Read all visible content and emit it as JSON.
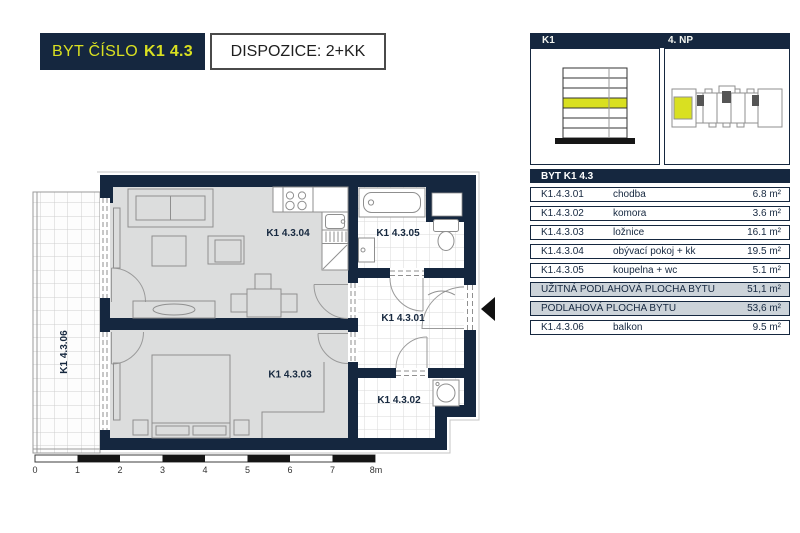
{
  "header": {
    "badge": {
      "prefix": "BYT ČÍSLO",
      "unit": "K1 4.3"
    },
    "layout_box": "DISPOZICE: 2+KK"
  },
  "info_panel": {
    "building": "K1",
    "floor": "4. NP",
    "table": {
      "title": "BYT K1 4.3",
      "rows": [
        {
          "code": "K1.4.3.01",
          "name": "chodba",
          "area": "6.8 m²"
        },
        {
          "code": "K1.4.3.02",
          "name": "komora",
          "area": "3.6 m²"
        },
        {
          "code": "K1.4.3.03",
          "name": "ložnice",
          "area": "16.1 m²"
        },
        {
          "code": "K1.4.3.04",
          "name": "obývací pokoj + kk",
          "area": "19.5 m²"
        },
        {
          "code": "K1.4.3.05",
          "name": "koupelna + wc",
          "area": "5.1 m²"
        }
      ],
      "summary_rows": [
        {
          "label": "UŽITNÁ PODLAHOVÁ PLOCHA BYTU",
          "area": "51,1 m²"
        },
        {
          "label": "PODLAHOVÁ PLOCHA BYTU",
          "area": "53,6 m²"
        }
      ],
      "balcony_row": {
        "code": "K1.4.3.06",
        "name": "balkon",
        "area": "9.5 m²"
      }
    }
  },
  "floor_plan": {
    "labels": [
      {
        "room": "living-kitchen",
        "text": "K1 4.3.04"
      },
      {
        "room": "bathroom",
        "text": "K1 4.3.05"
      },
      {
        "room": "hallway",
        "text": "K1 4.3.01"
      },
      {
        "room": "bedroom",
        "text": "K1 4.3.03"
      },
      {
        "room": "storage",
        "text": "K1 4.3.02"
      },
      {
        "room": "balcony",
        "text": "K1 4.3.06"
      }
    ],
    "scale_ticks": [
      "0",
      "1",
      "2",
      "3",
      "4",
      "5",
      "6",
      "7",
      "8m"
    ]
  },
  "colors": {
    "navy": "#15273f",
    "accent_yellow": "#d9e021",
    "floor_gray": "#dcdddd",
    "summary_gray": "#ccd3d9"
  }
}
